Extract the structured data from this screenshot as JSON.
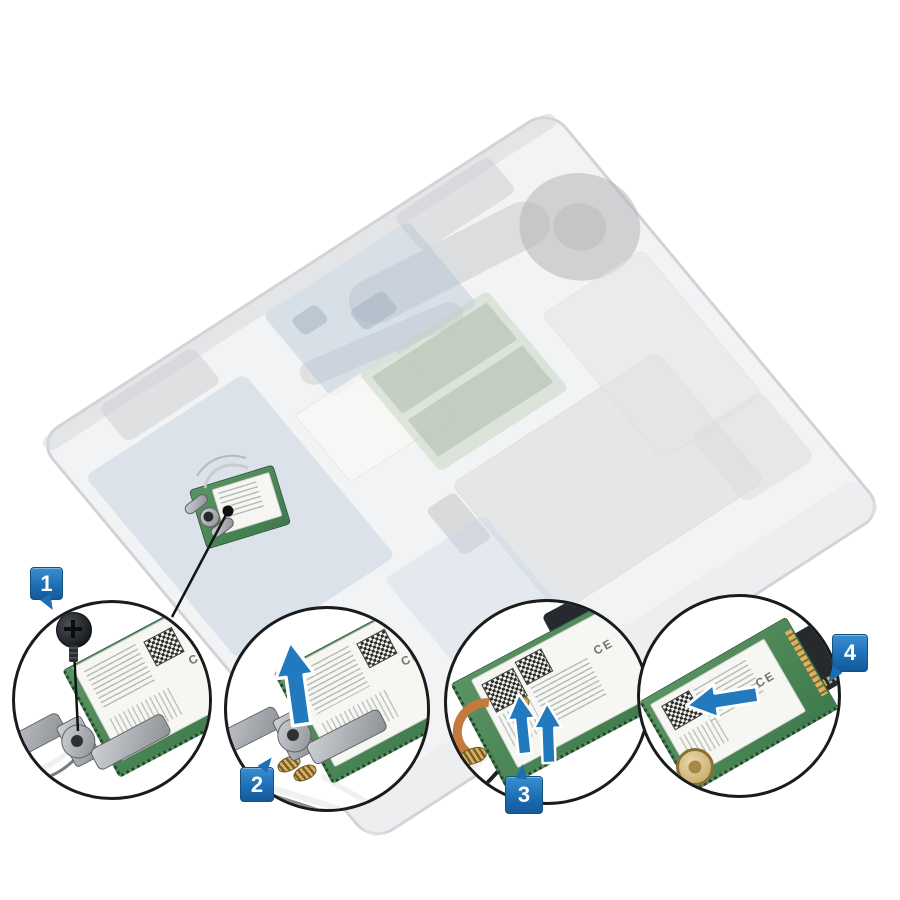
{
  "figure": {
    "type": "hardware-service-diagram",
    "subject": "wlan-card-removal",
    "ce_mark": "CE",
    "steps": [
      {
        "number": "1",
        "action": "remove-bracket-screw"
      },
      {
        "number": "2",
        "action": "lift-wlan-bracket"
      },
      {
        "number": "3",
        "action": "disconnect-antenna-cables"
      },
      {
        "number": "4",
        "action": "slide-out-wlan-card"
      }
    ],
    "icons": {
      "step2": "arrow-up-icon",
      "step3": "arrow-up-icon",
      "step4": "arrow-left-icon"
    },
    "colors": {
      "callout_blue": "#1d6fb5",
      "circle_outline": "#1a1b1d",
      "pcb_green": "#4e8857",
      "label_white": "#f6f6f2",
      "metal_gray": "#a9adb1",
      "copper": "#c5793c",
      "gold": "#cfa854",
      "slot_black": "#26292d"
    }
  }
}
